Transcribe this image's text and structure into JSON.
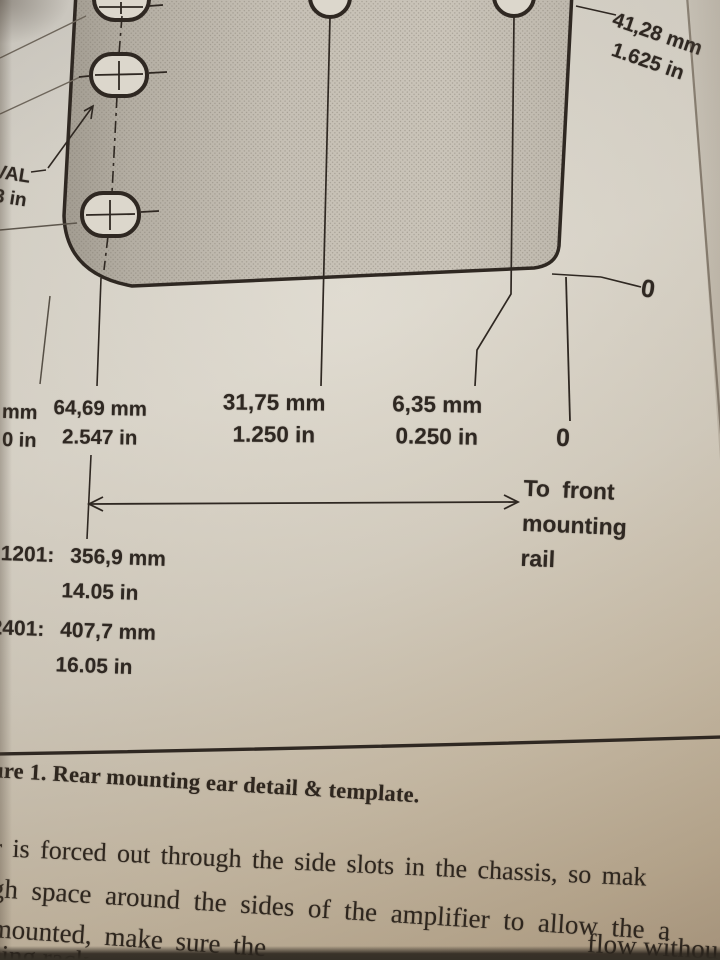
{
  "colors": {
    "ink": "#2f2822",
    "paper": "#d9d4c9",
    "template_gray": "#bfb9ad"
  },
  "figure": {
    "oval_label_line1": "OVAL",
    "oval_label_line2": "53 in",
    "dim_top_right_mm": "41,28 mm",
    "dim_top_right_in": "1.625 in",
    "zero_top": "0",
    "zero_bottom": "0",
    "dim_left_cut_mm": "20 mm",
    "dim_left_cut_in": "0 in",
    "dim_6469_mm": "64,69 mm",
    "dim_6469_in": "2.547 in",
    "dim_3175_mm": "31,75 mm",
    "dim_3175_in": "1.250 in",
    "dim_635_mm": "6,35 mm",
    "dim_635_in": "0.250 in",
    "to_front_line1": "To front",
    "to_front_line2": "mounting",
    "to_front_line3": "rail",
    "model_1201_label": "1201:",
    "model_1201_mm": "356,9 mm",
    "model_1201_in": "14.05 in",
    "model_2401_label": "2401:",
    "model_2401_mm": "407,7 mm",
    "model_2401_in": "16.05 in"
  },
  "caption": "ure 1. Rear mounting ear detail & template.",
  "body": {
    "line1": "r is forced out through the side slots in the chassis, so mak",
    "line2": "gh space around the sides of the amplifier to allow the a",
    "line3_left": "mounted, make sure the",
    "line3_right": "flow withou",
    "line4": "sing rack"
  }
}
